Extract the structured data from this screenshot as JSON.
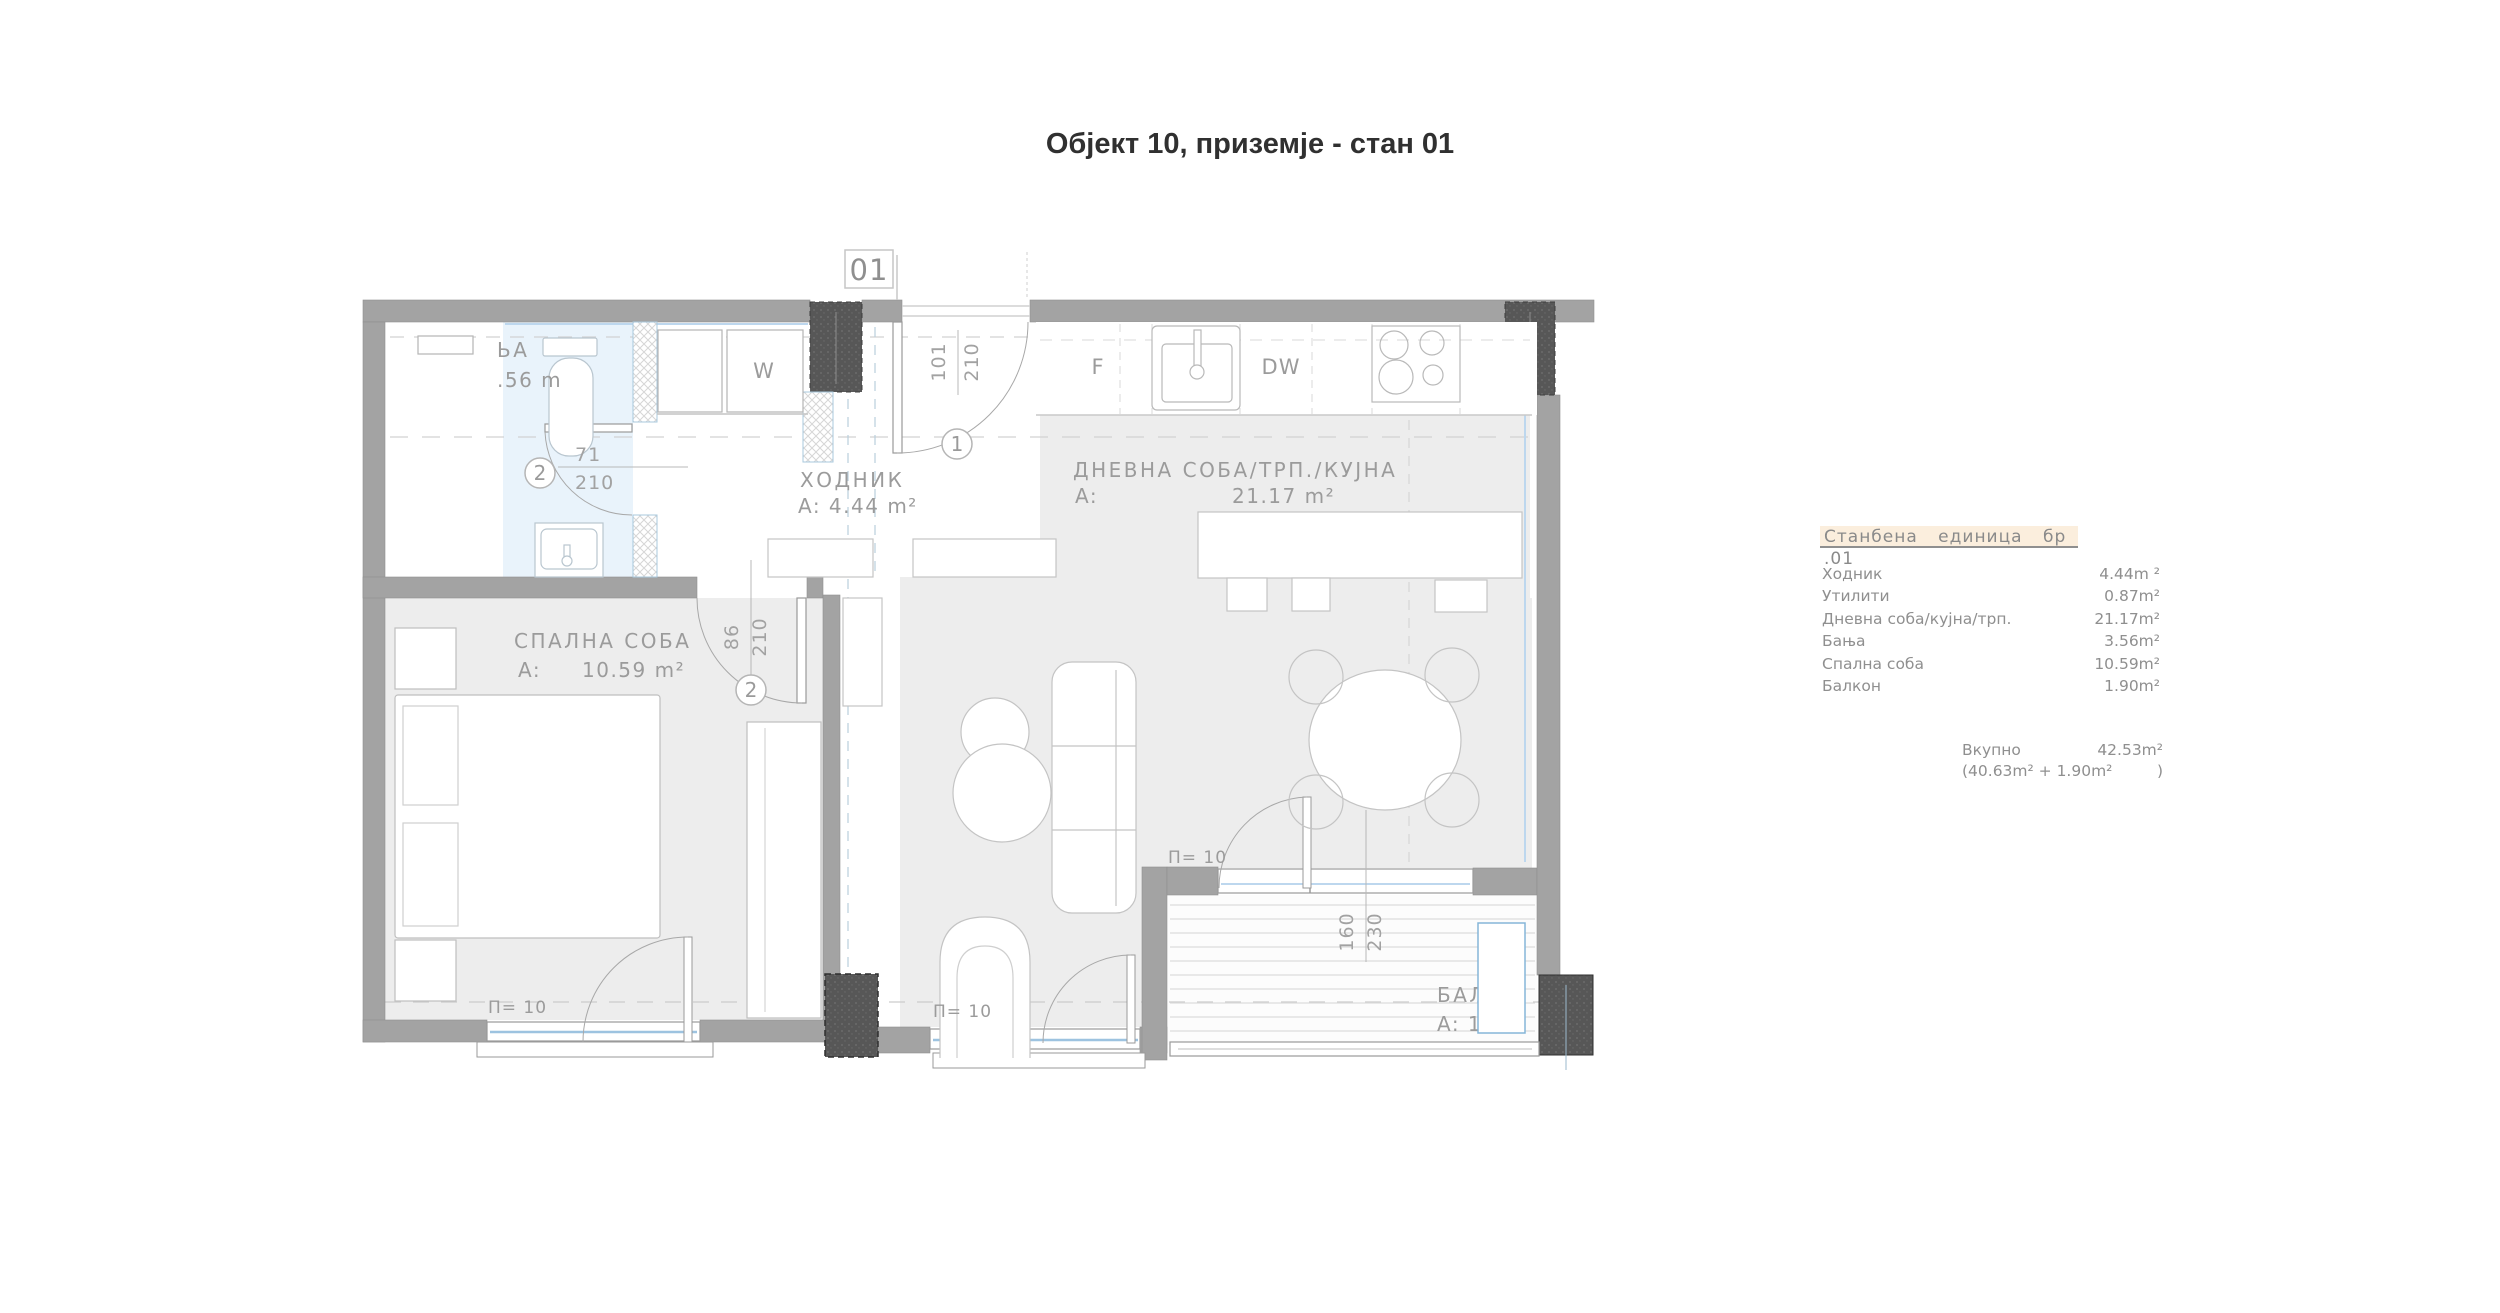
{
  "title": "Објект 10, приземје - стан 01",
  "unit_badge": "01",
  "plan": {
    "rooms": {
      "hallway": {
        "name": "ХОДНИК",
        "area": "A: 4.44 m²"
      },
      "living": {
        "name": "ДНЕВНА СОБА/ТРП./КУЈНА",
        "area_prefix": "A:",
        "area": "21.17 m²"
      },
      "bedroom": {
        "name": "СПАЛНА СОБА",
        "area_prefix": "A:",
        "area": "10.59 m²"
      },
      "bathroom": {
        "name_fragment": "ЬА",
        "area_fragment": ".56 m"
      },
      "balcony": {
        "name_fragment": "БАЛК",
        "area_fragment": "A: 1."
      }
    },
    "appliances": {
      "fridge": "F",
      "dishwasher": "DW",
      "washer": "W"
    },
    "doors": {
      "entry": {
        "marker": "1",
        "w": "101",
        "h": "210"
      },
      "bathroom": {
        "marker": "2",
        "w": "71",
        "h": "210"
      },
      "bedroom": {
        "marker": "2",
        "w": "86",
        "h": "210"
      },
      "balcony": {
        "w": "160",
        "h": "230"
      }
    },
    "window_marks": [
      "П= 10",
      "П= 10",
      "П= 10"
    ]
  },
  "legend": {
    "header": "Станбена единица бр .01",
    "rows": [
      {
        "label": "Ходник",
        "value": "4.44m ²"
      },
      {
        "label": "Утилити",
        "value": "0.87m²"
      },
      {
        "label": "Дневна соба/кујна/трп.",
        "value": "21.17m²"
      },
      {
        "label": "Бања",
        "value": "3.56m²"
      },
      {
        "label": "Спална соба",
        "value": "10.59m²"
      },
      {
        "label": "Балкон",
        "value": "1.90m²"
      }
    ],
    "total_label": "Вкупно",
    "total_value": "42.53m²",
    "total_breakdown": "(40.63m² + 1.90m²",
    "total_close": ")"
  },
  "colors": {
    "wall": "#a3a3a3",
    "column": "#575757",
    "floor": "#ededed",
    "bathroom_floor": "#e9f3fb",
    "glazing": "#9dc3e0",
    "riser_warm": "#cc8d72",
    "riser_cool": "#a9cce8",
    "legend_highlight": "#fbeedd",
    "text_gray": "#8f8f8f",
    "title_text": "#303030"
  }
}
